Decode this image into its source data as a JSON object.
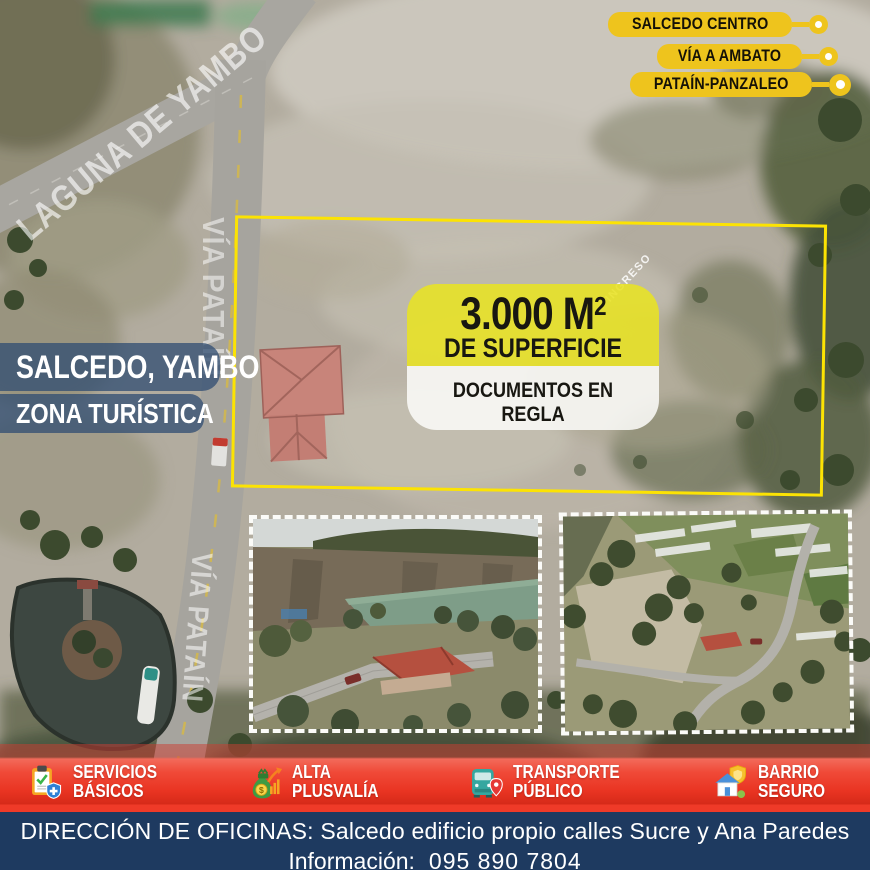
{
  "badges": [
    {
      "label": "SALCEDO CENTRO"
    },
    {
      "label": "VÍA A AMBATO"
    },
    {
      "label": "PATAÍN-PANZALEO"
    }
  ],
  "map_labels": {
    "road_top_left": "LAGUNA DE YAMBO",
    "road_upper": "VÍA PATAÍN",
    "road_lower": "VÍA PATAÍN",
    "entrance": "INGRESO"
  },
  "location_tags": {
    "city": "SALCEDO, YAMBO",
    "zone": "ZONA TURÍSTICA"
  },
  "plot_card": {
    "area_value": "3.000 M",
    "area_exponent": "2",
    "area_caption": "DE SUPERFICIE",
    "documents": "DOCUMENTOS EN REGLA"
  },
  "features": [
    {
      "icon": "clipboard-check-shield-icon",
      "line1": "SERVICIOS",
      "line2": "BÁSICOS"
    },
    {
      "icon": "money-bag-growth-icon",
      "line1": "ALTA",
      "line2": "PLUSVALÍA"
    },
    {
      "icon": "bus-location-pin-icon",
      "line1": "TRANSPORTE",
      "line2": "PÚBLICO"
    },
    {
      "icon": "house-shield-icon",
      "line1": "BARRIO",
      "line2": "SEGURO"
    }
  ],
  "footer": {
    "address_line": "DIRECCIÓN DE OFICINAS: Salcedo edificio propio calles Sucre y Ana Paredes",
    "info_label": "Información:",
    "phone": "095 890 7804"
  },
  "colors": {
    "badge_yellow": "#eec41d",
    "plot_outline_yellow": "#fce303",
    "card_yellow": "rgba(232,226,35,0.88)",
    "ribbon_blue": "rgba(47,76,114,0.75)",
    "band_red": "#ef3a28",
    "footer_navy": "#1e3a60"
  }
}
